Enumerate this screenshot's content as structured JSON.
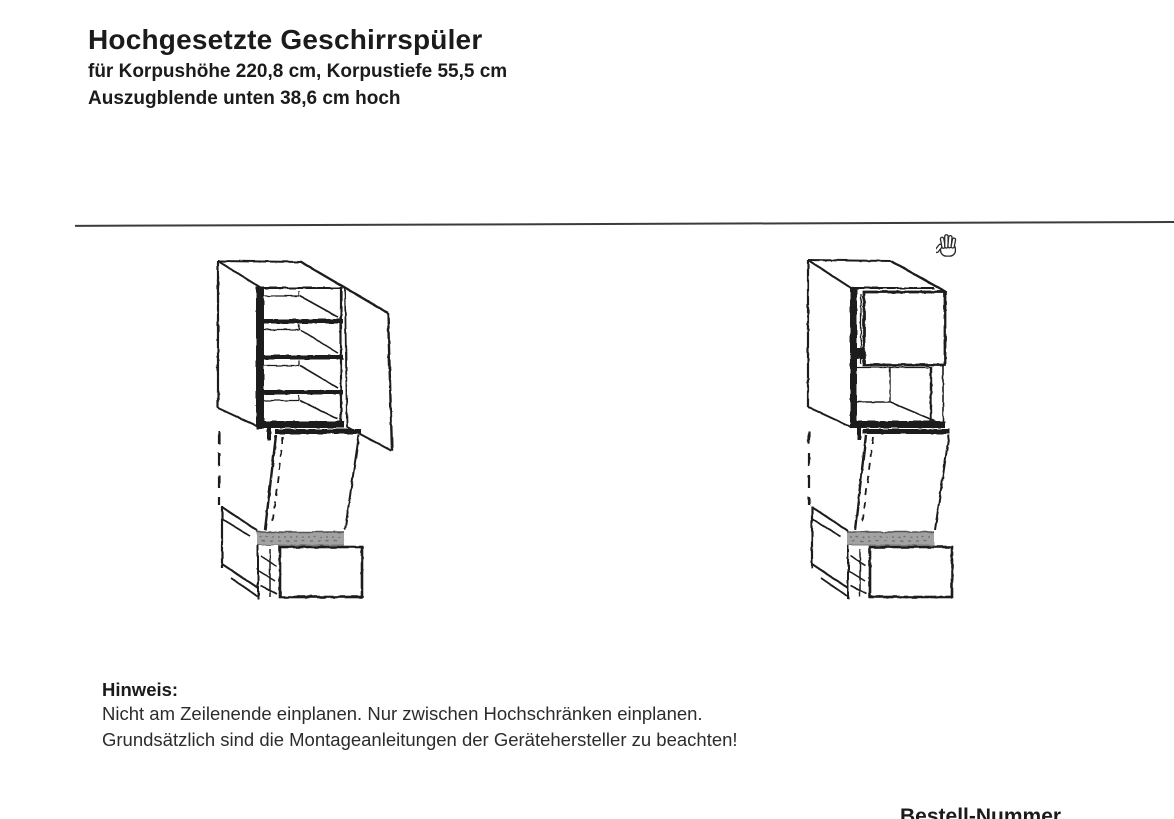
{
  "header": {
    "title": "Hochgesetzte Geschirrspüler",
    "subtitle_line1": "für Korpushöhe 220,8 cm, Korpustiefe 55,5 cm",
    "subtitle_line2": "Auszugblende unten 38,6 cm hoch"
  },
  "note": {
    "heading": "Hinweis:",
    "line1": "Nicht am Zeilenende einplanen. Nur zwischen Hochschränken einplanen.",
    "line2": "Grundsätzlich sind die Montageanleitungen der Gerätehersteller zu beachten!"
  },
  "footer": {
    "order_number_label": "Bestell-Nummer"
  },
  "icons": {
    "cursor": "open-hand-cursor-icon"
  },
  "colors": {
    "ink": "#1f1f1f",
    "dishwasher_panel_gray": "#a2a2a2",
    "divider": "#3c3c3c",
    "paper": "#ffffff"
  }
}
